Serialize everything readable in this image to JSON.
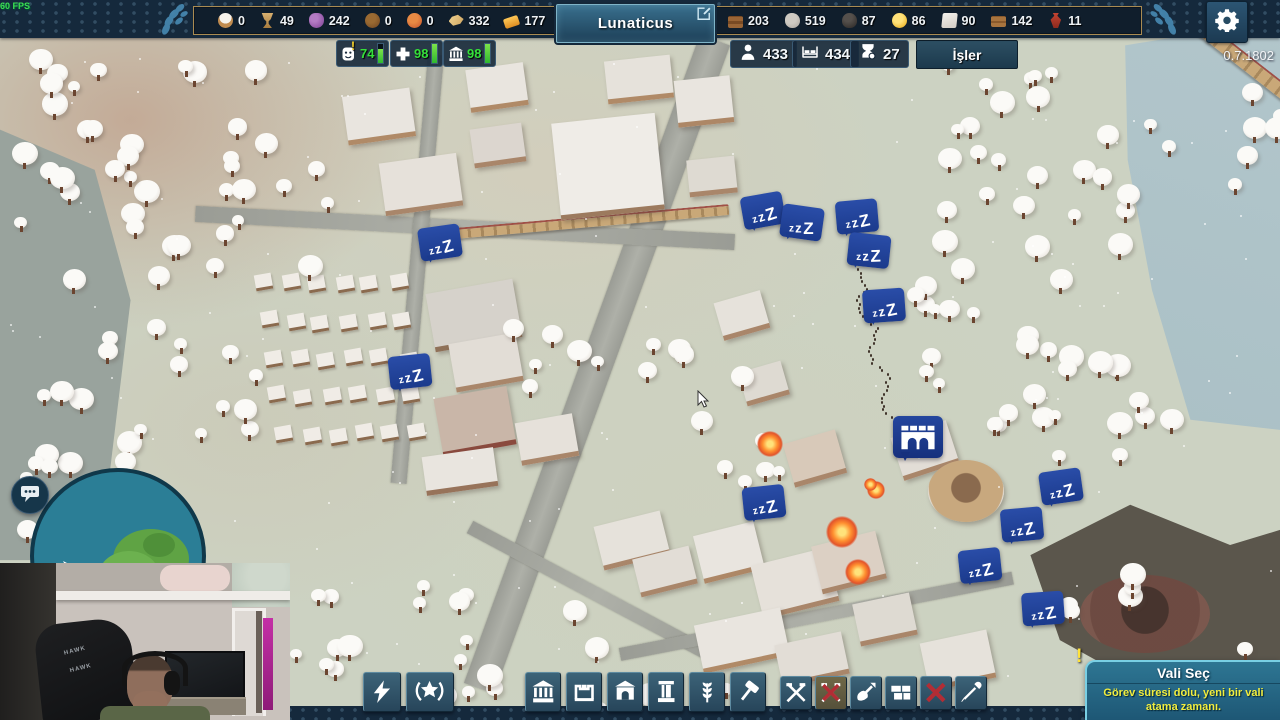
{
  "fps_counter": "60 FPS",
  "version": "0.7.1802",
  "top_bar": {
    "city_name": "Lunaticus",
    "left_resources": [
      {
        "icon": "flour",
        "value": "0"
      },
      {
        "icon": "goblet",
        "value": "49"
      },
      {
        "icon": "grapes",
        "value": "242"
      },
      {
        "icon": "olive",
        "value": "0"
      },
      {
        "icon": "fruit",
        "value": "0"
      },
      {
        "icon": "fish",
        "value": "332"
      },
      {
        "icon": "goldbar",
        "value": "177"
      }
    ],
    "right_resources": [
      {
        "icon": "wood",
        "value": "203"
      },
      {
        "icon": "stone",
        "value": "519"
      },
      {
        "icon": "iron",
        "value": "87"
      },
      {
        "icon": "coin",
        "value": "86"
      },
      {
        "icon": "marble",
        "value": "90"
      },
      {
        "icon": "bricks",
        "value": "142"
      },
      {
        "icon": "amphora",
        "value": "11"
      }
    ]
  },
  "status_bar": {
    "alert_char": "!",
    "stats": [
      {
        "icon": "happiness",
        "value": "74",
        "pct": 74,
        "alert": true
      },
      {
        "icon": "health",
        "value": "98",
        "pct": 98,
        "alert": false
      },
      {
        "icon": "culture",
        "value": "98",
        "pct": 98,
        "alert": false
      }
    ],
    "population": [
      {
        "icon": "citizens",
        "value": "433"
      },
      {
        "icon": "housing",
        "value": "434"
      },
      {
        "icon": "waiting",
        "value": "27"
      }
    ],
    "jobs_button_label": "İşler"
  },
  "toolbar": {
    "left_buttons": [
      {
        "icon": "bolt"
      },
      {
        "icon": "wreath-star"
      }
    ],
    "main_buttons": [
      {
        "icon": "temple"
      },
      {
        "icon": "walls"
      },
      {
        "icon": "shrine"
      },
      {
        "icon": "column"
      },
      {
        "icon": "wheat"
      },
      {
        "icon": "hammer"
      }
    ],
    "right_buttons": [
      {
        "icon": "crossed-tools"
      },
      {
        "icon": "crossed-tools-disabled",
        "selected": true
      },
      {
        "icon": "shovel"
      },
      {
        "icon": "blocks"
      },
      {
        "icon": "demolish-x"
      },
      {
        "icon": "picker"
      }
    ]
  },
  "notification": {
    "alert_char": "!",
    "title": "Vali Seç",
    "message": "Görev süresi dolu, yeni bir vali atama zamanı."
  },
  "map": {
    "sleep_label": "zzZ",
    "sleep_markers": [
      [
        437,
        239,
        -8
      ],
      [
        407,
        368,
        -6
      ],
      [
        760,
        207,
        -10
      ],
      [
        799,
        219,
        8
      ],
      [
        854,
        213,
        -5
      ],
      [
        866,
        247,
        6
      ],
      [
        881,
        302,
        -4
      ],
      [
        761,
        499,
        -6
      ],
      [
        1058,
        483,
        -8
      ],
      [
        1019,
        521,
        -5
      ],
      [
        977,
        562,
        -6
      ],
      [
        1040,
        605,
        -4
      ]
    ],
    "aqueduct_marker": [
      893,
      416
    ]
  },
  "webcam": {
    "chair_brand": "HAWK"
  },
  "colors": {
    "topbar": "#15293c",
    "gold_trim": "#a98b52",
    "panel_blue": "#2e5a74",
    "badge_blue": "#1e3f92",
    "accent_green": "#35e03a",
    "notification_teal": "#276d8b",
    "alert_yellow": "#f2ee3e"
  }
}
